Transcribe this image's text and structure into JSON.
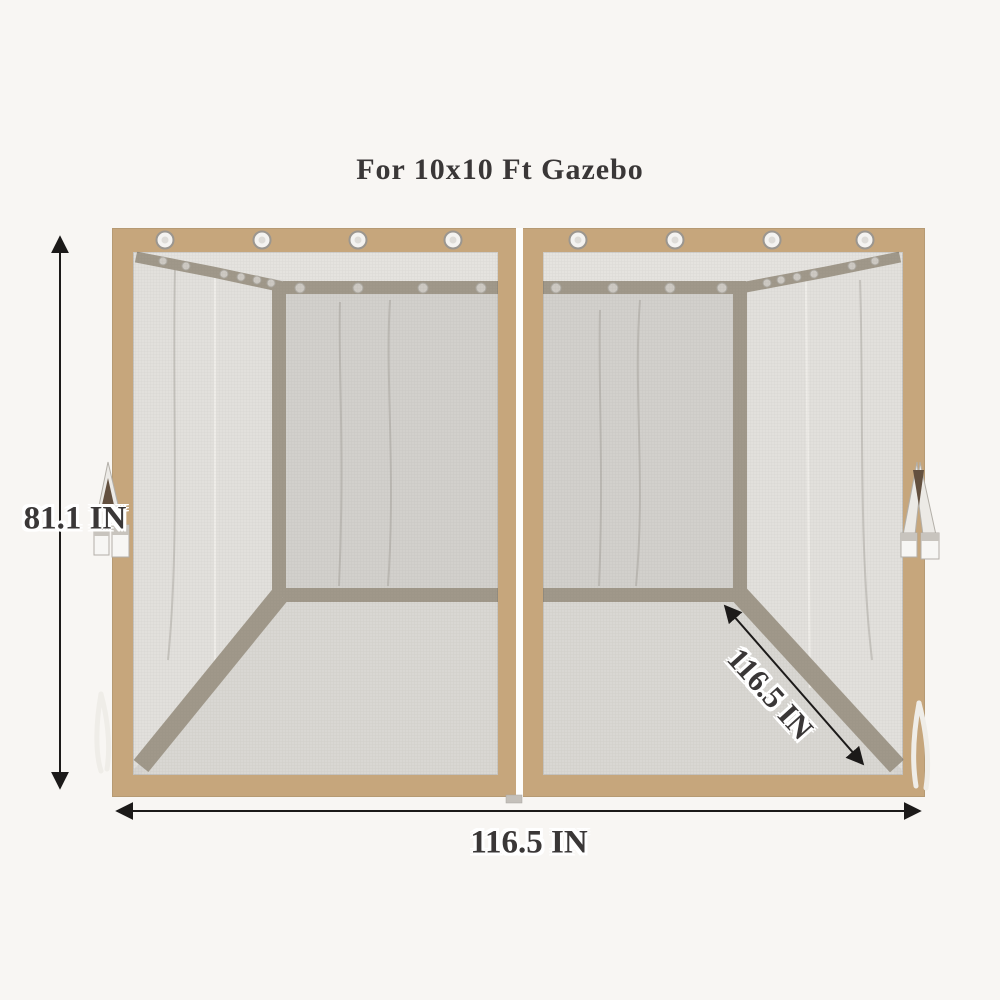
{
  "title": "For 10x10 Ft Gazebo",
  "annotations": {
    "height_label": "81.1 IN",
    "width_label": "116.5 IN",
    "depth_label": "116.5 IN"
  },
  "illustration": {
    "panel_count": 2,
    "grommets_per_panel": 4
  },
  "colors": {
    "bg": "#f8f6f3",
    "tan": "#c6a67c",
    "tan-edge": "#b69a73",
    "strip": "#a0988a",
    "mesh": "#d6d4d1",
    "mesh-roof": "#e5e3df",
    "mesh-back": "#d2d0cc",
    "mesh-floor": "#d9d7d3",
    "mesh-drape": "#e2e0dc",
    "line": "#1c1a19",
    "text": "#3a3737"
  }
}
